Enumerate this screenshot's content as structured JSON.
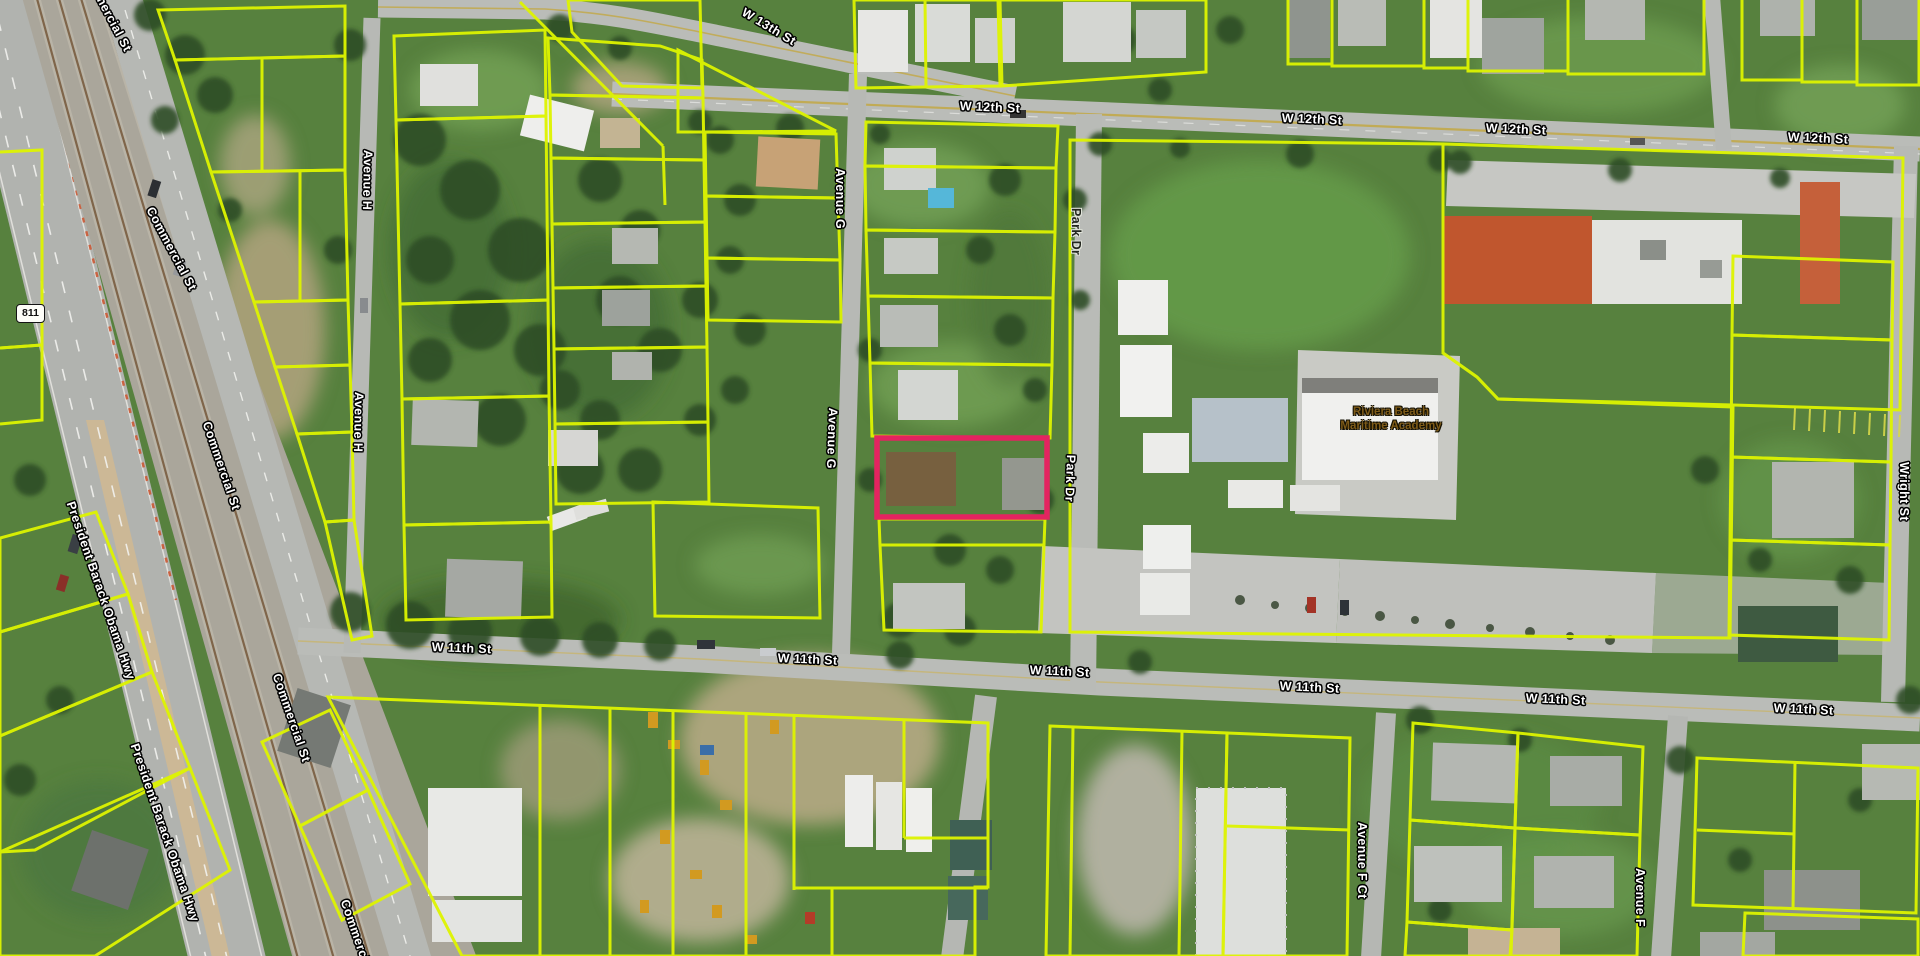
{
  "map_type": "aerial-parcel-viewer",
  "route_shield": {
    "text": "811"
  },
  "places": {
    "academy": {
      "line1": "Riviera Beach",
      "line2": "Maritime Academy"
    }
  },
  "parcels": {
    "line_color": "#def400",
    "highlight_color": "#e32460",
    "highlighted_parcel": "outlined in pink/red near Avenue G and Park Dr"
  },
  "streets": {
    "labels": [
      {
        "text": "W 13th St"
      },
      {
        "text": "W 12th St"
      },
      {
        "text": "W 12th St"
      },
      {
        "text": "W 12th St"
      },
      {
        "text": "W 12th St"
      },
      {
        "text": "W 11th St"
      },
      {
        "text": "W 11th St"
      },
      {
        "text": "W 11th St"
      },
      {
        "text": "W 11th St"
      },
      {
        "text": "W 11th St"
      },
      {
        "text": "W 11th St"
      },
      {
        "text": "Avenue H"
      },
      {
        "text": "Avenue H"
      },
      {
        "text": "Avenue G"
      },
      {
        "text": "Avenue G"
      },
      {
        "text": "Park Dr"
      },
      {
        "text": "Park Dr"
      },
      {
        "text": "Avenue F Ct"
      },
      {
        "text": "Avenue F"
      },
      {
        "text": "Wright St"
      },
      {
        "text": "Commercial St"
      },
      {
        "text": "Commercial St"
      },
      {
        "text": "Commercial St"
      },
      {
        "text": "Commercial St"
      },
      {
        "text": "Commercial St"
      },
      {
        "text": "President Barack Obama Hwy"
      },
      {
        "text": "President Barack Obama Hwy"
      }
    ]
  }
}
